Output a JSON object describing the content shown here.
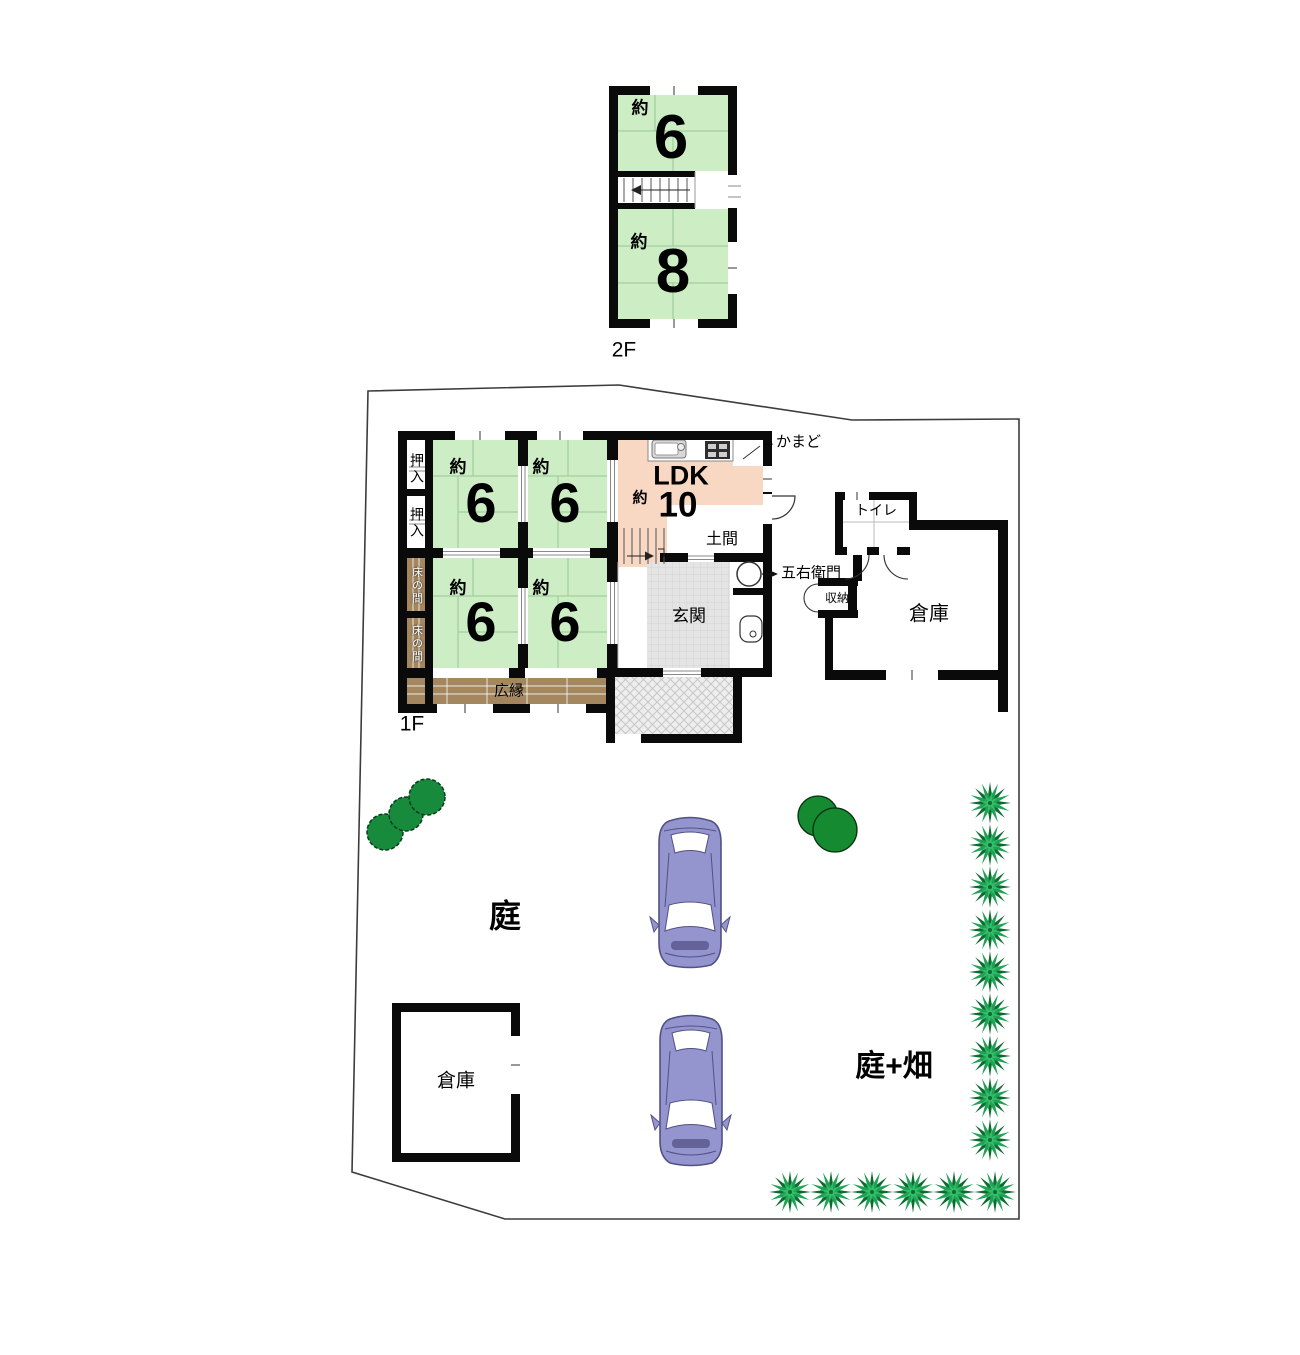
{
  "floor2": {
    "label": "2F",
    "room6": {
      "prefix": "約",
      "value": "6"
    },
    "room8": {
      "prefix": "約",
      "value": "8"
    }
  },
  "floor1": {
    "label": "1F",
    "rooms": [
      {
        "prefix": "約",
        "value": "6"
      },
      {
        "prefix": "約",
        "value": "6"
      },
      {
        "prefix": "約",
        "value": "6"
      },
      {
        "prefix": "約",
        "value": "6"
      }
    ],
    "ldk": {
      "title": "LDK",
      "prefix": "約",
      "value": "10"
    },
    "doma": "土間",
    "genkan": "玄関",
    "hiroen": "広縁",
    "oshiire": [
      "押入",
      "押入"
    ],
    "tokonoma": [
      "床の間",
      "床の間"
    ],
    "toilet": "トイレ",
    "storage_small": "収納",
    "warehouse": "倉庫",
    "kamado_note": "→かまど",
    "goemon_note": "五右衛門"
  },
  "site": {
    "garden": "庭",
    "garden_field": "庭+畑",
    "warehouse": "倉庫"
  },
  "colors": {
    "tatami": "#cdedc4",
    "ldk": "#f8d7c3",
    "wood": "#a4875e",
    "genkan_tile": "#e4e4e4",
    "wall": "#0a0a0a",
    "car_body": "#9494ce",
    "car_outline": "#515183",
    "plant_green": "#1fa254",
    "plant_dark": "#0d6b31",
    "tree_green": "#178a3b",
    "boundary": "#3c3c3c"
  }
}
